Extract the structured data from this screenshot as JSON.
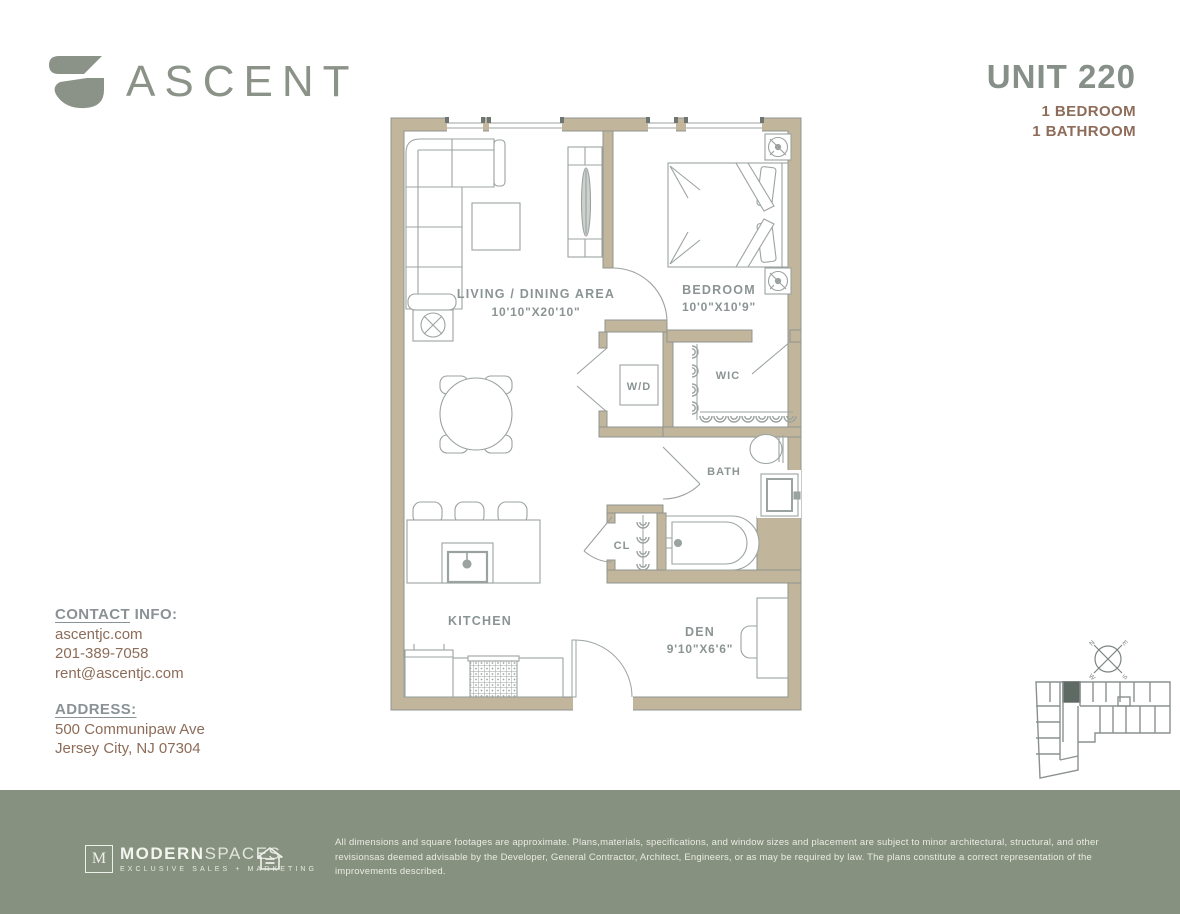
{
  "brand": {
    "name": "ASCENT"
  },
  "unit": {
    "number": "UNIT 220",
    "bedrooms": "1 BEDROOM",
    "bathrooms": "1 BATHROOM"
  },
  "contact": {
    "label_underline": "CONTACT",
    "label_rest": " INFO:",
    "website": "ascentjc.com",
    "phone": "201-389-7058",
    "email": "rent@ascentjc.com"
  },
  "address": {
    "label": "ADDRESS:",
    "line1": "500 Communipaw Ave",
    "line2": "Jersey City, NJ 07304"
  },
  "floorplan": {
    "rooms": {
      "living": {
        "label": "LIVING / DINING AREA",
        "dims": "10'10\"X20'10\""
      },
      "bedroom": {
        "label": "BEDROOM",
        "dims": "10'0\"X10'9\""
      },
      "wic": {
        "label": "WIC"
      },
      "wd": {
        "label": "W/D"
      },
      "bath": {
        "label": "BATH"
      },
      "cl": {
        "label": "CL"
      },
      "kitchen": {
        "label": "KITCHEN"
      },
      "den": {
        "label": "DEN",
        "dims": "9'10\"X6'6\""
      }
    }
  },
  "compass": {
    "n": "N",
    "e": "E",
    "s": "S",
    "w": "W"
  },
  "footer": {
    "agency": {
      "initial": "M",
      "name_bold": "MODERN",
      "name_light": "SPACES",
      "tagline": "EXCLUSIVE SALES + MARKETING"
    },
    "disclaimer": "All dimensions and square footages are approximate. Plans,materials, specifications, and window sizes and placement are subject to minor architectural, structural, and other revisionsas deemed advisable by the Developer, General Contractor, Architect, Engineers, or as may be required by law. The plans constitute a correct representation of the improvements described."
  },
  "colors": {
    "wall": "#c1b59c",
    "wall_stroke": "#8f958f",
    "line": "#9ba3a0",
    "label": "#8b9494",
    "brown": "#8d6c59",
    "brand": "#8b9288",
    "footer_bg": "#87917f",
    "keyplan_highlight": "#5f6a64"
  }
}
